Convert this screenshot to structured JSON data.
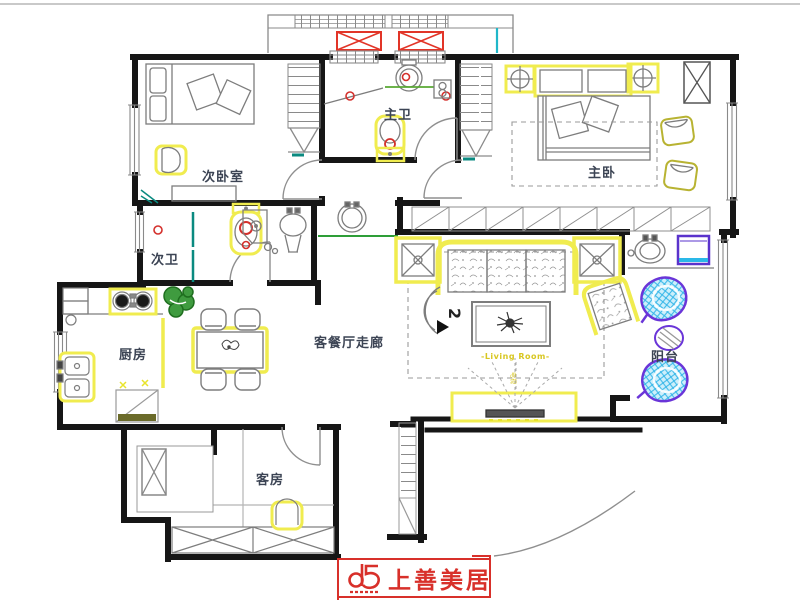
{
  "plan": {
    "rooms": [
      {
        "id": "secondary-bedroom",
        "label": "次卧室"
      },
      {
        "id": "secondary-bath",
        "label": "次卫"
      },
      {
        "id": "master-bath",
        "label": "主卫"
      },
      {
        "id": "master-bedroom",
        "label": "主卧"
      },
      {
        "id": "kitchen",
        "label": "厨房"
      },
      {
        "id": "living-dining-hall",
        "label": "客餐厅走廊"
      },
      {
        "id": "guest-room",
        "label": "客房"
      },
      {
        "id": "balcony",
        "label": "阳台"
      }
    ],
    "annotations": {
      "living_room": "-Living Room-",
      "marker": "2",
      "tv": "电视"
    },
    "colors": {
      "wall": "#161616",
      "highlight": "#f0ec4f",
      "accent_red": "#e23528",
      "teal": "#0a8a80",
      "purple": "#6a35d8",
      "cyan": "#2ab8e8",
      "green": "#2e8b2e"
    }
  },
  "logo": {
    "text": "上善美居"
  }
}
